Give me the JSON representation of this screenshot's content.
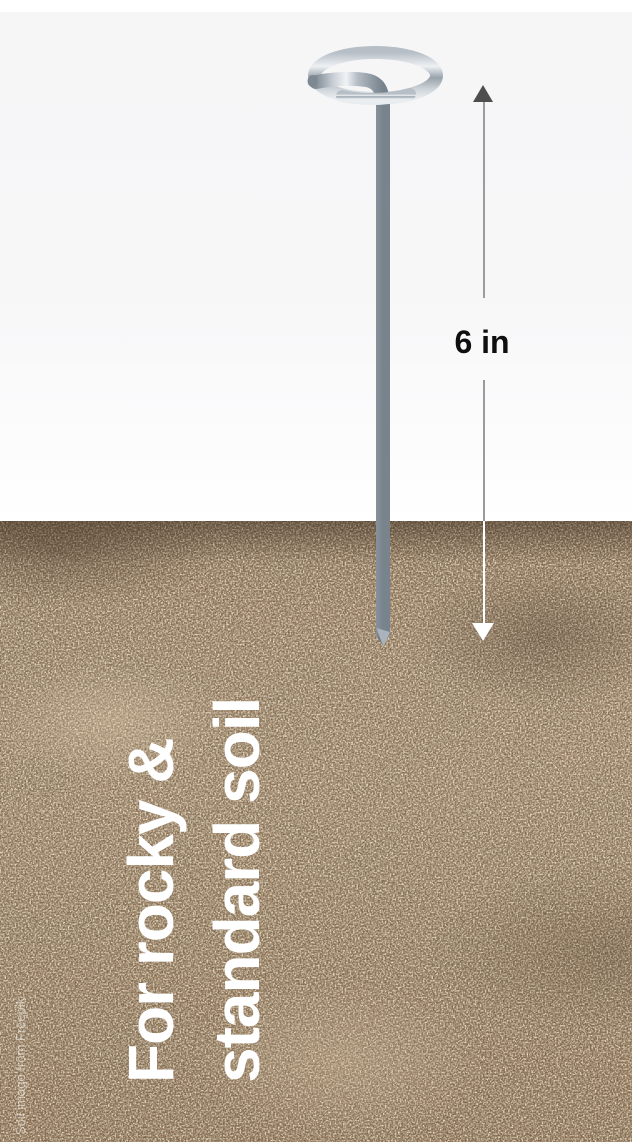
{
  "measurement": {
    "label": "6 in"
  },
  "caption": {
    "line1": "For rocky &",
    "line2": "standard soil"
  },
  "credit": {
    "text": "Soil image from Freepik"
  },
  "icons": {
    "arrow_up": "triangle-up",
    "arrow_down": "triangle-down"
  },
  "colors": {
    "background_top": "#f7f7f8",
    "soil_base": "#a3886a",
    "soil_dark_speckle": "#3c2e1f",
    "soil_light_speckle": "#dbc8a8",
    "caption_text": "#ffffff",
    "measurement_text": "#0f0f0f",
    "measurement_line_upper": "#9b9b9b",
    "measurement_line_lower": "#ffffff",
    "arrow_up_fill": "#4e4e4e",
    "arrow_down_fill": "#ffffff",
    "metal_highlight": "#f0f3f6",
    "metal_shadow": "#79838c"
  }
}
